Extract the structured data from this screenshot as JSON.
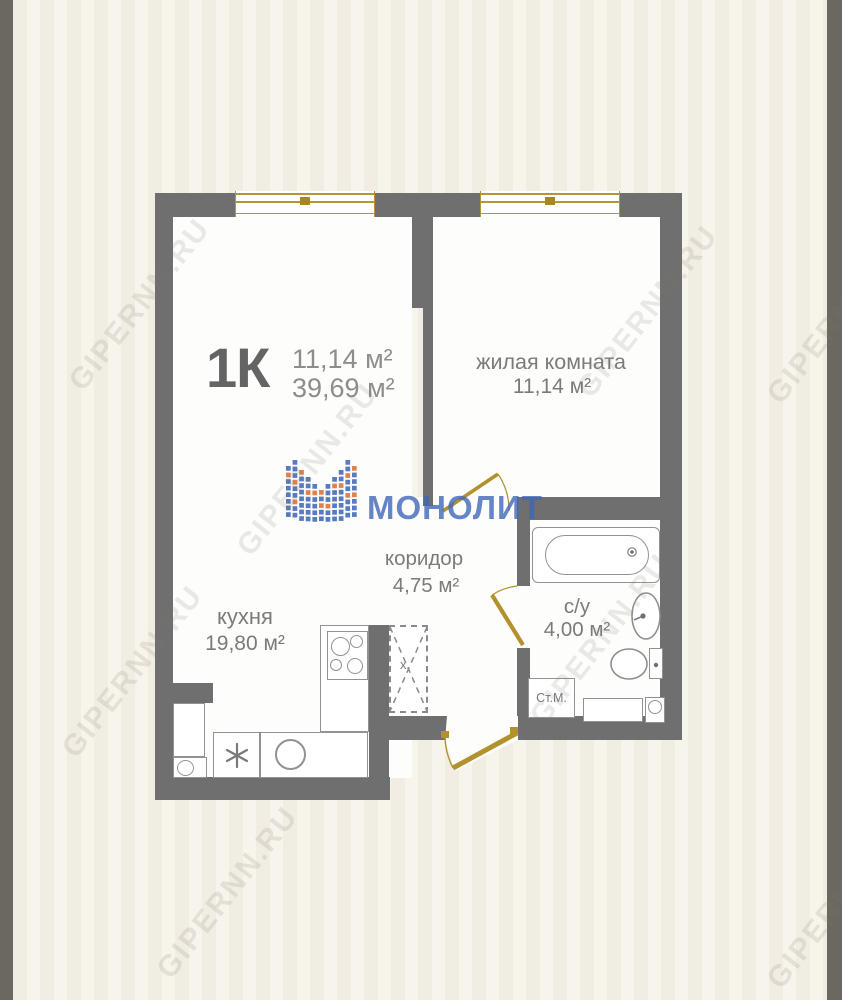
{
  "plan": {
    "type_label": "1К",
    "area_small": "11,14 м²",
    "area_total": "39,69 м²"
  },
  "rooms": {
    "living": {
      "name": "жилая комната",
      "area": "11,14 м²"
    },
    "kitchen": {
      "name": "кухня",
      "area": "19,80 м²"
    },
    "corridor": {
      "name": "коридор",
      "area": "4,75 м²"
    },
    "bathroom": {
      "name": "с/у",
      "area": "4,00 м²"
    }
  },
  "fixtures": {
    "washing_machine": "Ст.М.",
    "vent_mark": "x"
  },
  "logo": {
    "text": "МОНОЛИТ"
  },
  "watermark": {
    "text": "GIPERNN.RU"
  },
  "colors": {
    "wall": "#6f6f6f",
    "door_gold": "#b2922f",
    "window_gold": "#b89434",
    "background": "#f2eee5",
    "frame_gray": "#6b6862",
    "logo_blue": "#4a6fbb",
    "logo_orange": "#e0773c"
  }
}
